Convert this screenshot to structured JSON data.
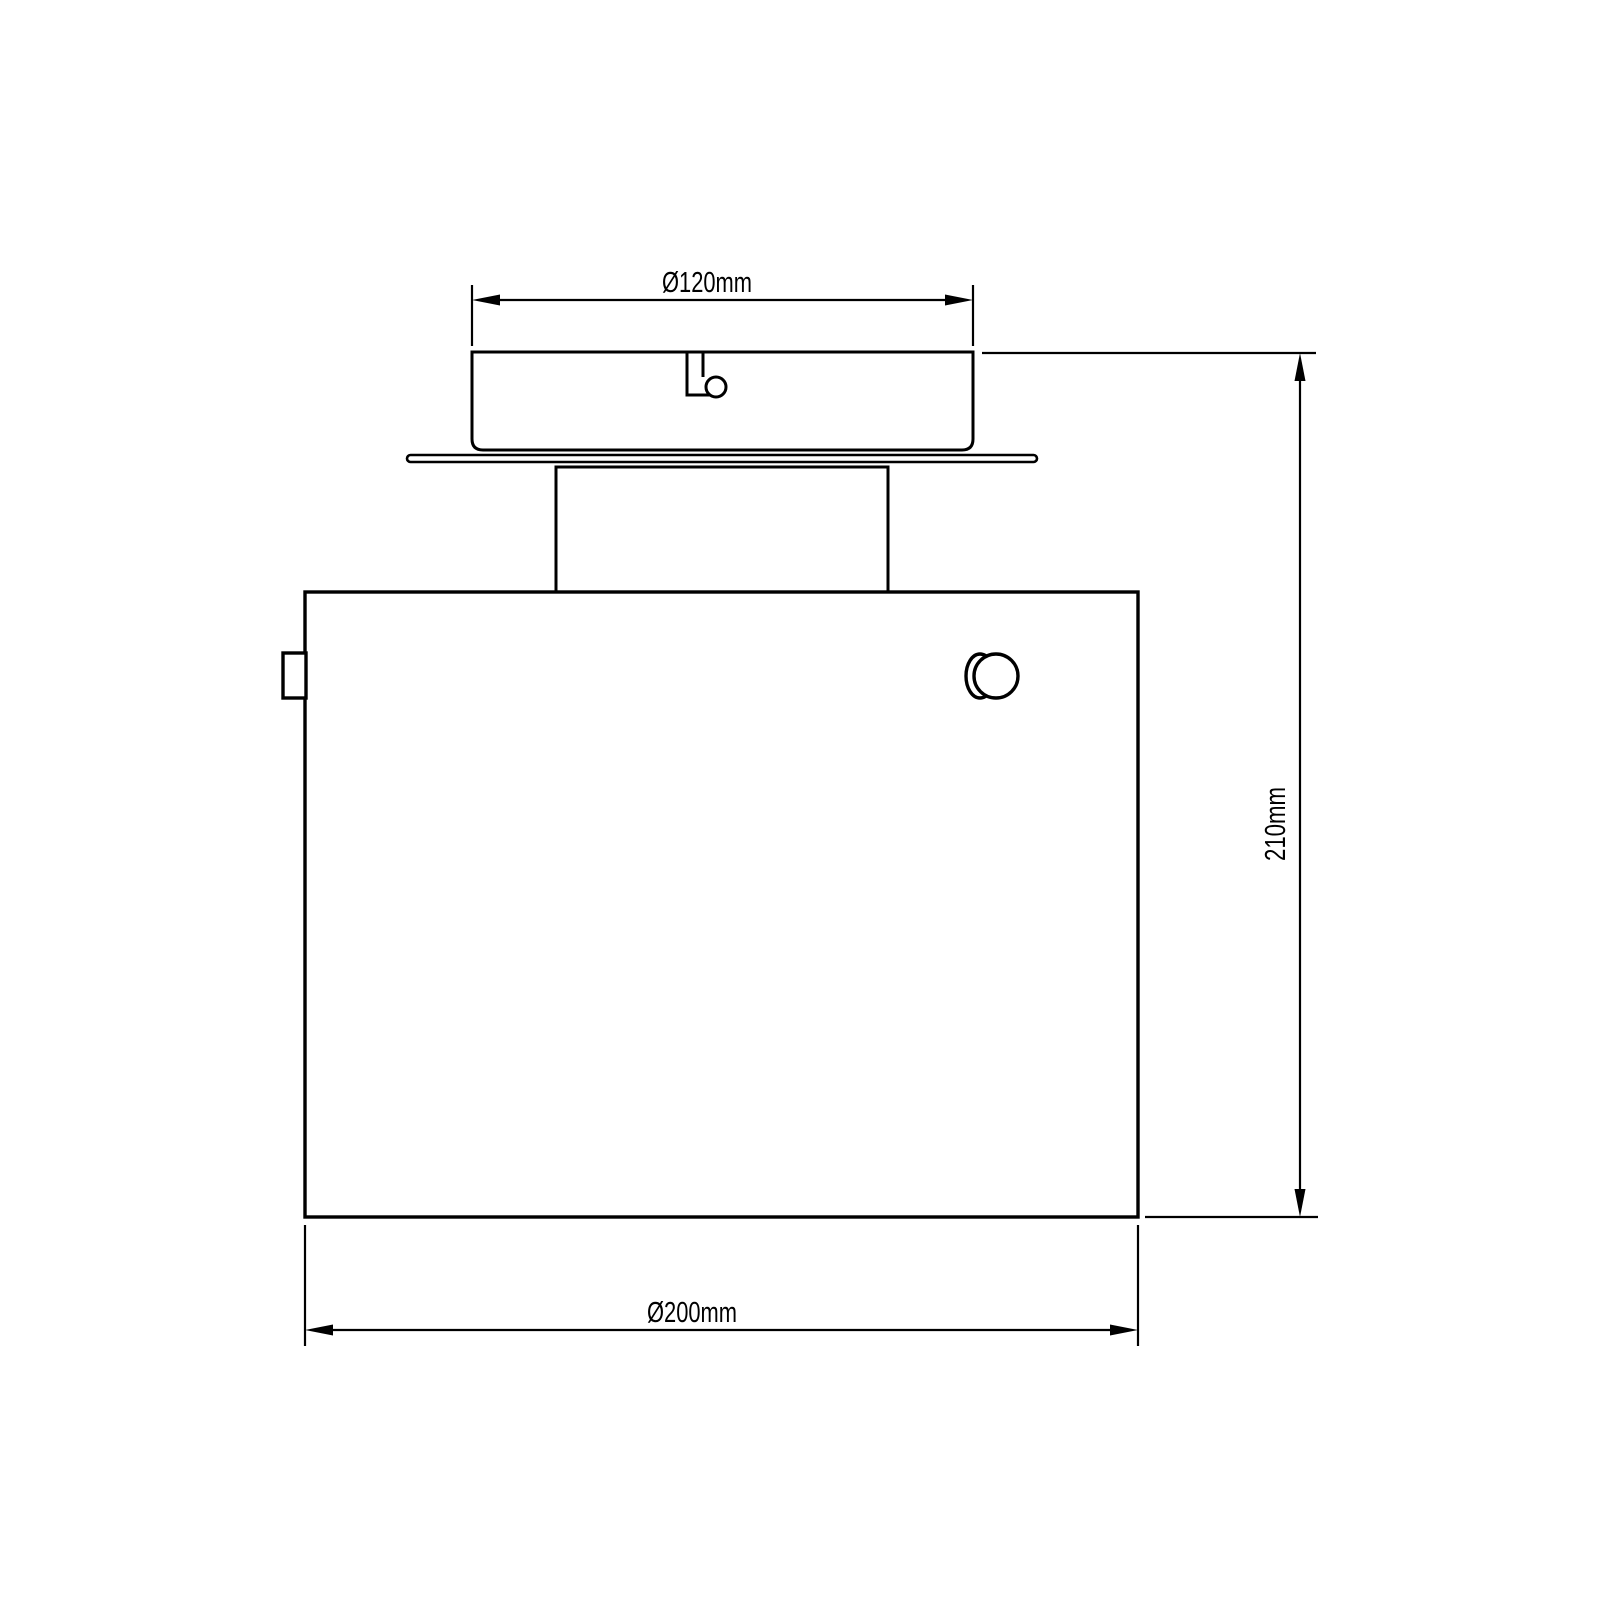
{
  "watermark": {
    "text": "svet-svitidel.cz",
    "color": "#e6e6e6"
  },
  "drawing": {
    "subject": "ceiling-light-fixture-technical-drawing",
    "background": "#ffffff",
    "line_color": "#000000",
    "labels": {
      "canopy_diameter": "Ø120mm",
      "fixture_height": "210mm",
      "shade_diameter": "Ø200mm"
    }
  }
}
